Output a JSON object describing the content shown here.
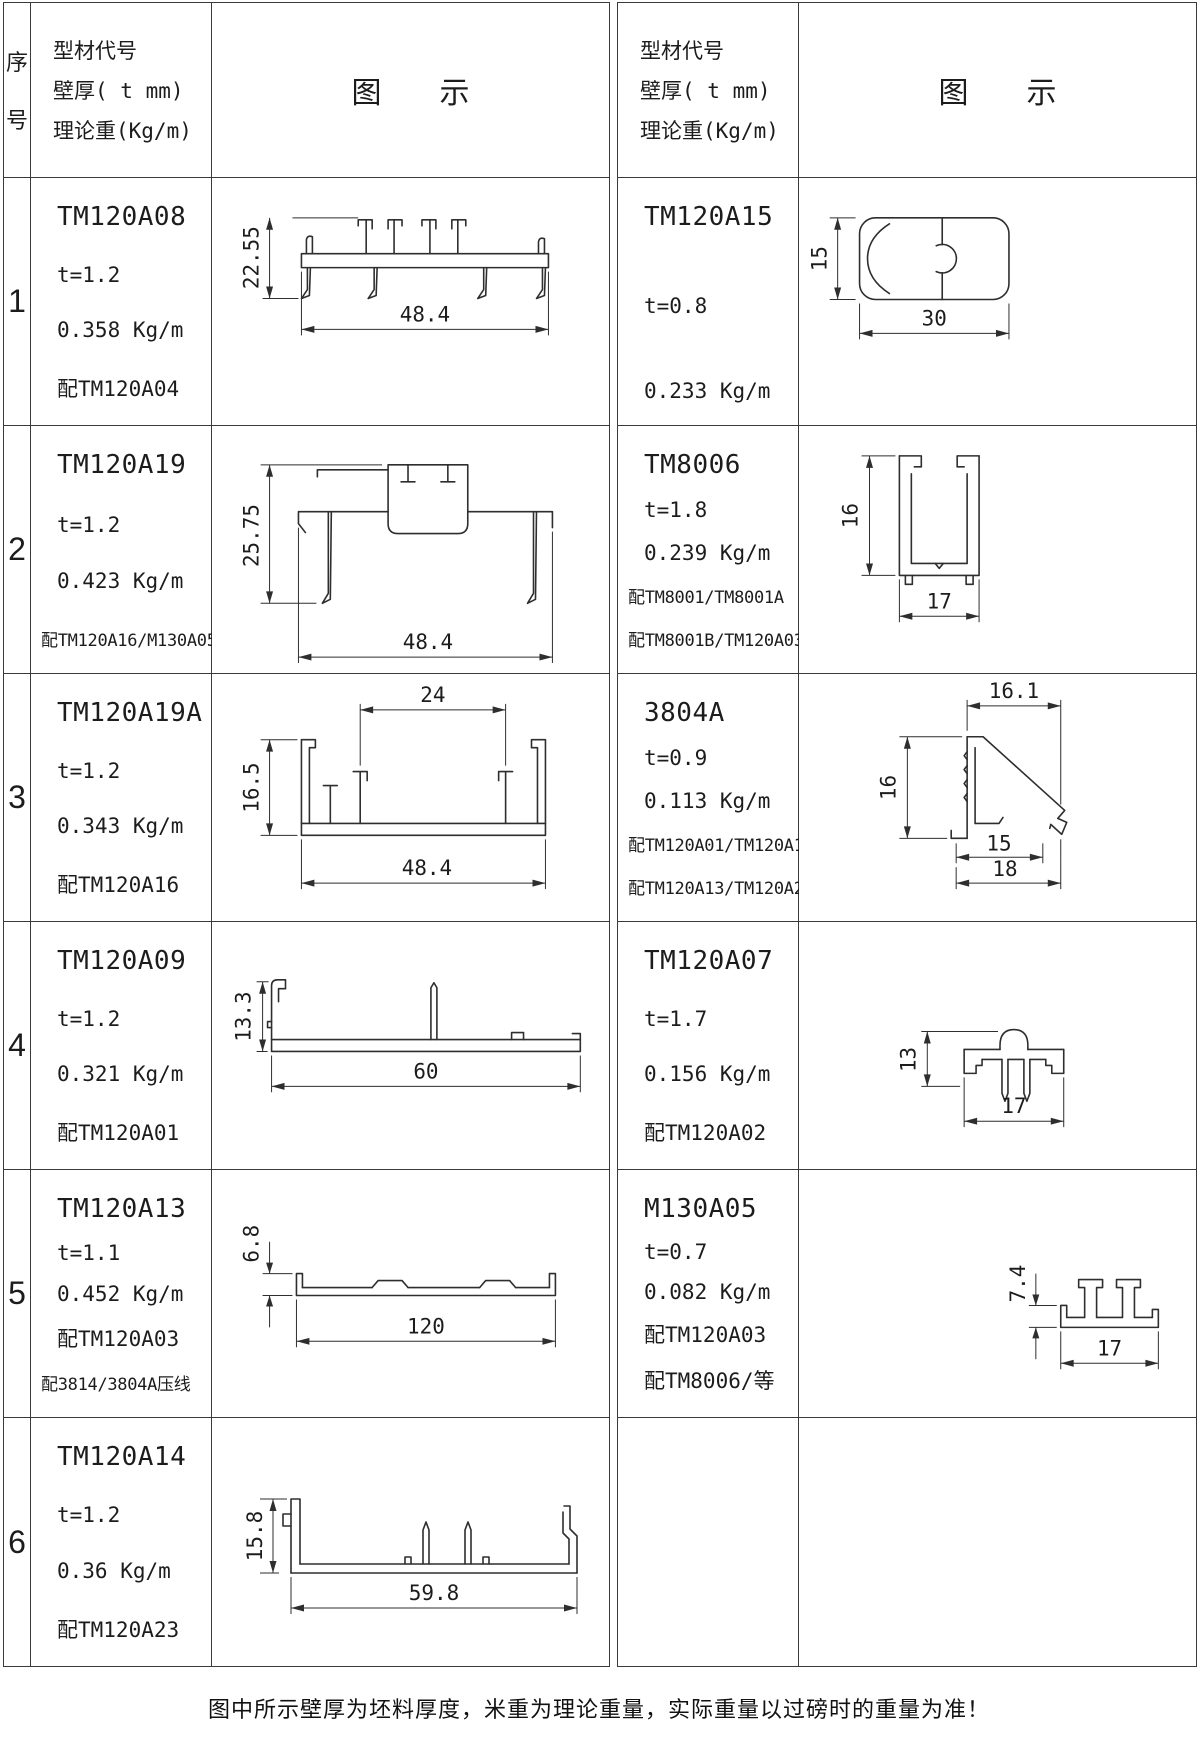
{
  "header": {
    "seq_label_top": "序",
    "seq_label_bottom": "号",
    "spec_line1": "型材代号",
    "spec_line2": "壁厚( t mm)",
    "spec_line3": "理论重(Kg/m)",
    "diagram_label_left": "图",
    "diagram_label_right": "示"
  },
  "rows": [
    {
      "num": "1",
      "left": {
        "code": "TM120A08",
        "lines": [
          "t=1.2",
          "0.358 Kg/m",
          "配TM120A04"
        ],
        "dims": {
          "v": "22.55",
          "h": "48.4"
        }
      },
      "right": {
        "code": "TM120A15",
        "lines": [
          "t=0.8",
          "0.233 Kg/m"
        ],
        "dims": {
          "v": "15",
          "h": "30"
        }
      }
    },
    {
      "num": "2",
      "left": {
        "code": "TM120A19",
        "lines": [
          "t=1.2",
          "0.423 Kg/m",
          "配TM120A16/M130A05"
        ],
        "dims": {
          "v": "25.75",
          "h": "48.4"
        }
      },
      "right": {
        "code": "TM8006",
        "lines": [
          "t=1.8",
          "0.239 Kg/m",
          "配TM8001/TM8001A",
          "配TM8001B/TM120A03"
        ],
        "dims": {
          "v": "16",
          "h": "17"
        }
      }
    },
    {
      "num": "3",
      "left": {
        "code": "TM120A19A",
        "lines": [
          "t=1.2",
          "0.343 Kg/m",
          "配TM120A16"
        ],
        "dims": {
          "top": "24",
          "v": "16.5",
          "h": "48.4"
        }
      },
      "right": {
        "code": "3804A",
        "lines": [
          "t=0.9",
          "0.113 Kg/m",
          "配TM120A01/TM120A11",
          "配TM120A13/TM120A21"
        ],
        "dims": {
          "top": "16.1",
          "v": "16",
          "h": "15",
          "h2": "18"
        }
      }
    },
    {
      "num": "4",
      "left": {
        "code": "TM120A09",
        "lines": [
          "t=1.2",
          "0.321 Kg/m",
          "配TM120A01"
        ],
        "dims": {
          "v": "13.3",
          "h": "60"
        }
      },
      "right": {
        "code": "TM120A07",
        "lines": [
          "t=1.7",
          "0.156 Kg/m",
          "配TM120A02"
        ],
        "dims": {
          "v": "13",
          "h": "17"
        }
      }
    },
    {
      "num": "5",
      "left": {
        "code": "TM120A13",
        "lines": [
          "t=1.1",
          "0.452 Kg/m",
          "配TM120A03",
          "配3814/3804A压线"
        ],
        "dims": {
          "v": "6.8",
          "h": "120"
        }
      },
      "right": {
        "code": "M130A05",
        "lines": [
          "t=0.7",
          "0.082 Kg/m",
          "配TM120A03",
          "配TM8006/等"
        ],
        "dims": {
          "v": "7.4",
          "h": "17"
        }
      }
    },
    {
      "num": "6",
      "left": {
        "code": "TM120A14",
        "lines": [
          "t=1.2",
          "0.36 Kg/m",
          "配TM120A23"
        ],
        "dims": {
          "v": "15.8",
          "h": "59.8"
        }
      },
      "right": null
    }
  ],
  "footer": {
    "note": "图中所示壁厚为坯料厚度，米重为理论重量，实际重量以过磅时的重量为准！"
  }
}
